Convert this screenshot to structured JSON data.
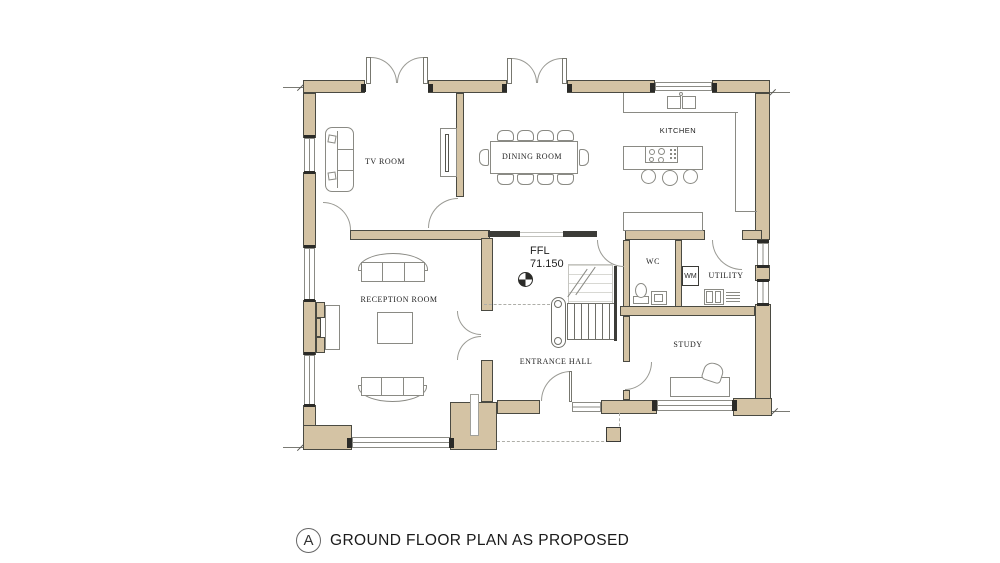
{
  "plan": {
    "rooms": {
      "tv": "TV ROOM",
      "dining": "DINING ROOM",
      "kitchen": "KITCHEN",
      "reception": "RECEPTION ROOM",
      "hall": "ENTRANCE HALL",
      "wc": "WC",
      "utility": "UTILITY",
      "study": "STUDY"
    },
    "appliances": {
      "wm": "WM"
    },
    "level": {
      "label": "FFL",
      "value": "71.150"
    }
  },
  "title": {
    "key_letter": "A",
    "text": "GROUND FLOOR PLAN AS PROPOSED"
  },
  "colors": {
    "wall_fill": "#d4c3a4",
    "wall_line": "#4a4a42",
    "furniture_line": "#8a8a84",
    "text": "#1f1f1f",
    "background": "#ffffff"
  }
}
